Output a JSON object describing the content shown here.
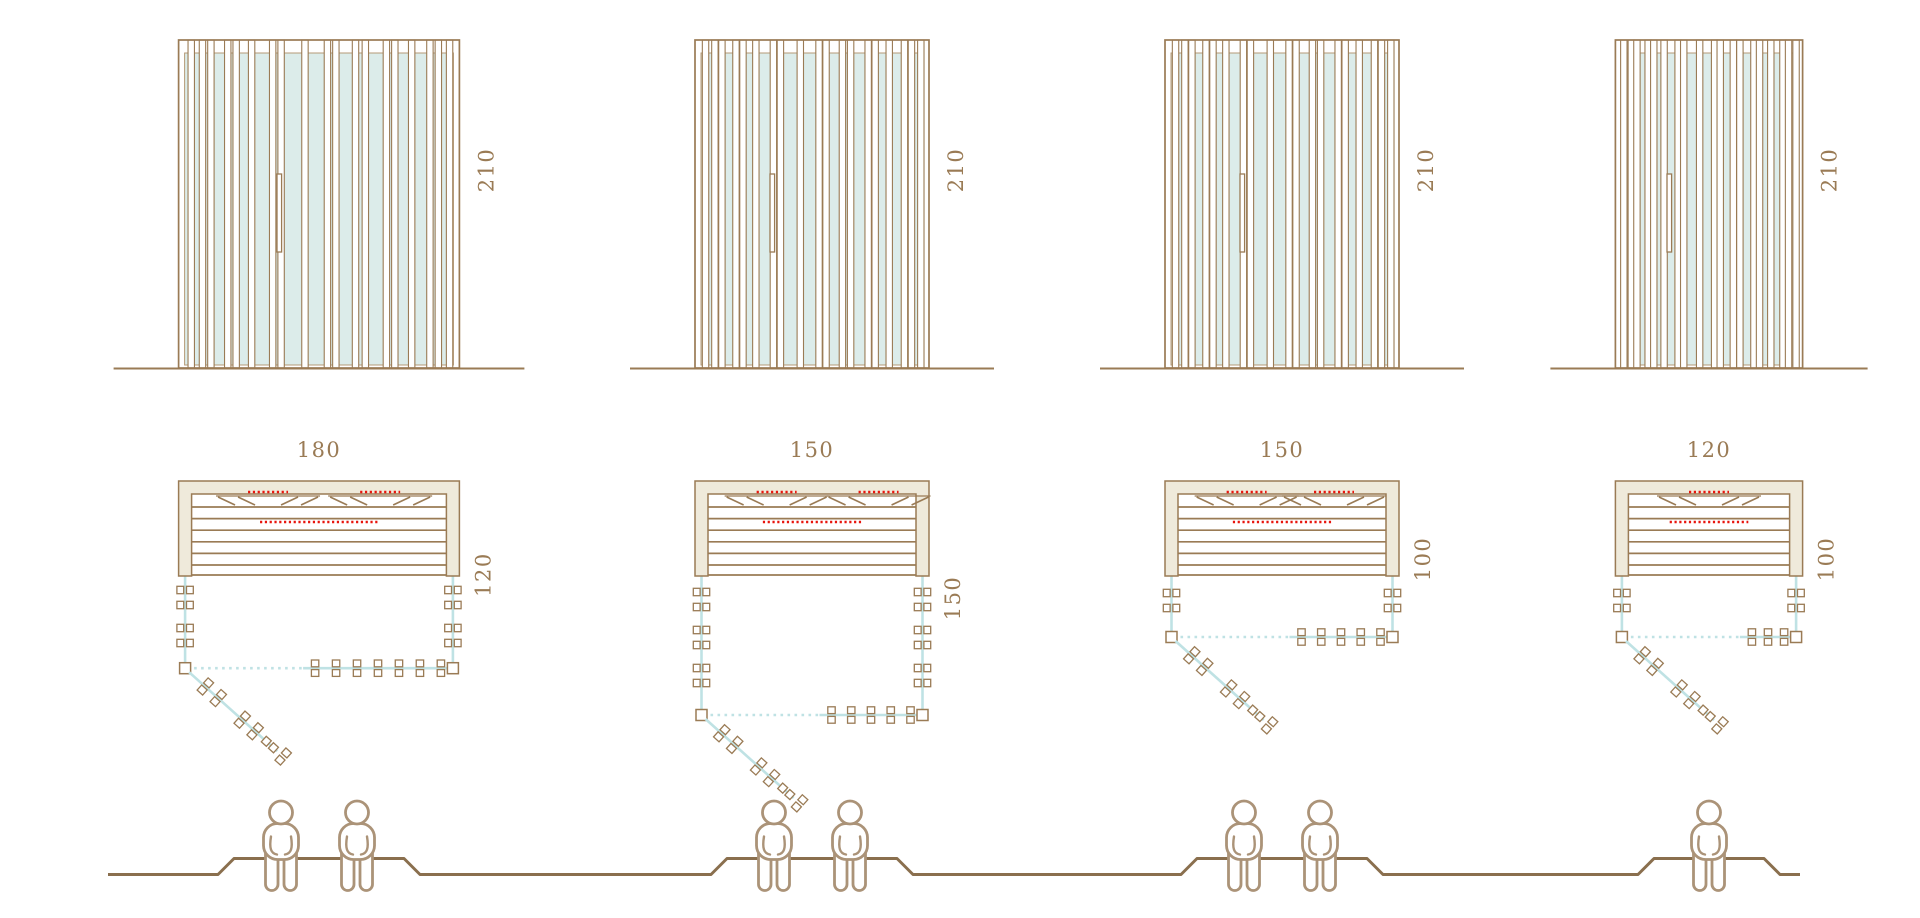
{
  "diagram": {
    "kind": "sauna-size-variants",
    "views": [
      "front-elevation",
      "floor-plan",
      "seating-capacity"
    ]
  },
  "variants": [
    {
      "name": "variant-180x120",
      "width_label": "180",
      "depth_label": "120",
      "height_label": "210",
      "capacity": 2
    },
    {
      "name": "variant-150x150",
      "width_label": "150",
      "depth_label": "150",
      "height_label": "210",
      "capacity": 2
    },
    {
      "name": "variant-150x100",
      "width_label": "150",
      "depth_label": "100",
      "height_label": "210",
      "capacity": 2
    },
    {
      "name": "variant-120x100",
      "width_label": "120",
      "depth_label": "100",
      "height_label": "210",
      "capacity": 1
    }
  ],
  "icons": {
    "person": "seated-person-outline",
    "clamp": "glass-clamp",
    "door": "open-glass-door"
  },
  "colors": {
    "line": "#9a7b55",
    "line_soft": "#b59a77",
    "profile": "#8a6f4e",
    "person": "#ab9378",
    "cream_fill": "#efeadb",
    "glass_fill": "#dcecea",
    "glass_line": "#bfe2e4",
    "heater_red": "#e8150d",
    "text": "#9a7b55",
    "background": "#ffffff"
  }
}
